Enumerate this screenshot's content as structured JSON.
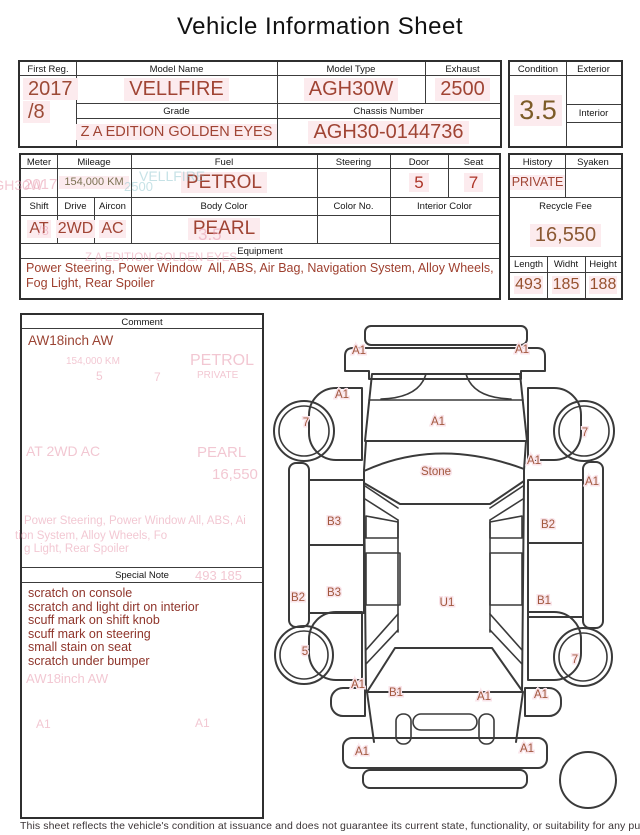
{
  "title": "Vehicle Information Sheet",
  "info_table": {
    "first_reg_label": "First Reg.",
    "first_reg_line1": "2017",
    "first_reg_line2": "/8",
    "model_name_label": "Model Name",
    "model_name": "VELLFIRE",
    "model_type_label": "Model Type",
    "model_type": "AGH30W",
    "exhaust_label": "Exhaust",
    "exhaust": "2500",
    "grade_label": "Grade",
    "grade": "Z A EDITION GOLDEN EYES",
    "chassis_label": "Chassis Number",
    "chassis_number": "AGH30-0144736"
  },
  "condition_box": {
    "condition_label": "Condition",
    "condition": "3.5",
    "exterior_label": "Exterior",
    "interior_label": "Interior"
  },
  "spec_table": {
    "meter_label": "Meter",
    "mileage_label": "Mileage",
    "mileage": "154,000 KM",
    "fuel_label": "Fuel",
    "fuel": "PETROL",
    "steering_label": "Steering",
    "door_label": "Door",
    "door": "5",
    "seat_label": "Seat",
    "seat": "7",
    "shift_label": "Shift",
    "shift": "AT",
    "drive_label": "Drive",
    "drive": "2WD",
    "aircon_label": "Aircon",
    "aircon": "AC",
    "body_color_label": "Body Color",
    "body_color": "PEARL",
    "color_no_label": "Color No.",
    "interior_color_label": "Interior Color",
    "equipment_label": "Equipment",
    "equipment": "Power Steering, Power Window  All, ABS, Air Bag, Navigation System, Alloy Wheels, Fog Light, Rear Spoiler"
  },
  "history_box": {
    "history_label": "History",
    "history": "PRIVATE",
    "syaken_label": "Syaken",
    "recycle_fee_label": "Recycle Fee",
    "recycle_fee": "16,550",
    "length_label": "Length",
    "length": "493",
    "width_label": "Widht",
    "width": "185",
    "height_label": "Height",
    "height": "188"
  },
  "comment_box": {
    "header": "Comment",
    "text": "AW18inch AW"
  },
  "special_note_box": {
    "header": "Special Note",
    "notes": [
      "scratch on console",
      "scratch and light dirt on interior",
      "scuff mark on shift knob",
      "scuff mark on steering",
      "small stain on seat",
      "scratch under bumper"
    ]
  },
  "diagram": {
    "labels": [
      "A1",
      "A1",
      "A1",
      "7",
      "7",
      "A1",
      "Stone",
      "A1",
      "A1",
      "B3",
      "B2",
      "B2",
      "B3",
      "U1",
      "B1",
      "5",
      "7",
      "A1",
      "B1",
      "A1",
      "A1",
      "A1",
      "A1"
    ]
  },
  "ghosts": [
    "AGH30W",
    "2017",
    "/8",
    "VELLFIRE",
    "2500",
    "3.5",
    "Z A EDITION GOLDEN EYES",
    "154,000 KM",
    "5",
    "7",
    "PETROL",
    "PRIVATE",
    "AT  2WD  AC",
    "PEARL",
    "16,550",
    "Power Steering, Power Window  All, ABS, Ai",
    "tion System, Alloy Wheels, Fo",
    "g Light, Rear Spoiler",
    "493   185",
    "AW18inch AW",
    "A1",
    "A1"
  ],
  "footer": {
    "disclaimer": "This sheet reflects the vehicle's condition at issuance and does not guarantee its current state, functionality, or suitability for any purpose"
  },
  "colors": {
    "value_red": "#a04434",
    "value_brown": "#8a5832",
    "highlight_pink": "#fcebee",
    "grid_line": "#3c3c3c",
    "ghost_pink": "#e89aae",
    "ghost_cyan": "#8fc6cf"
  }
}
